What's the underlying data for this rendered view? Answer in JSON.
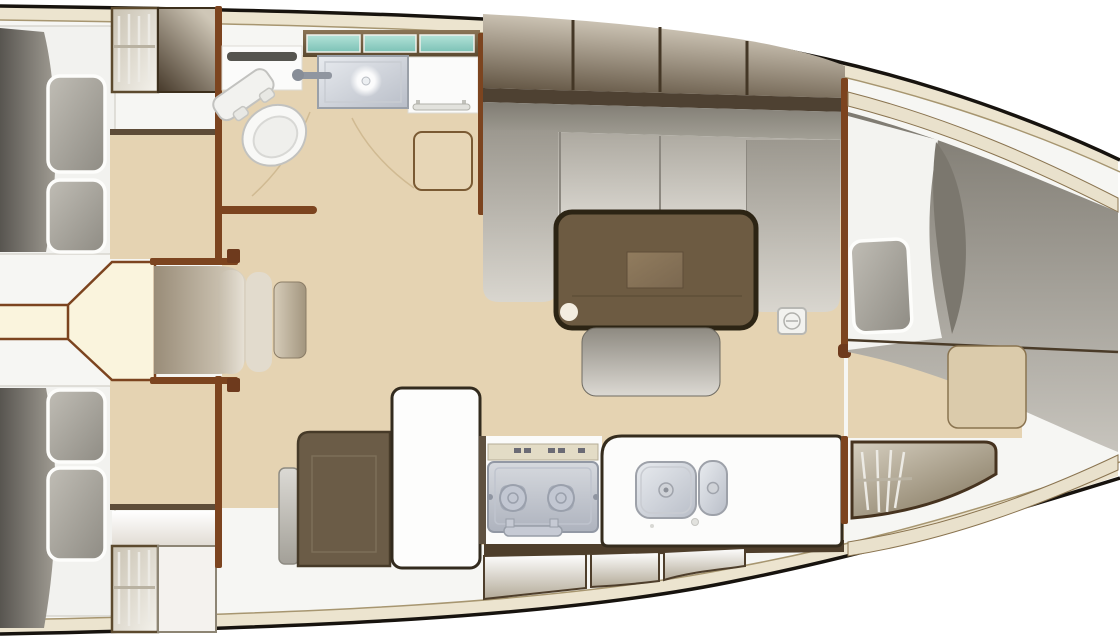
{
  "diagram": {
    "kind": "yacht-interior-floor-plan",
    "view": "top-down",
    "orientation": "bow-right-stern-left",
    "visible_text": []
  },
  "palette": {
    "background": "#ffffff",
    "hull_outline": "#17130e",
    "deck_band": "#ece4cf",
    "inner_white": "#f6f6f3",
    "floor_tan": "#e5d3b2",
    "companionway_ivory": "#faf4dd",
    "wall_wood": "#7c441f",
    "dark_trim": "#3a3020",
    "table_wood": "#6d5b42",
    "cabinet_dark": "#6b5c47",
    "cabinet_gradient_light": "#d7cfc0",
    "upholstery_gray": "#a7a39a",
    "mattress_gray": "#8f8b82",
    "metal_gray": "#c6cad3",
    "teal_glass": "#8fd0c4",
    "fixture_white": "#fbfbfa",
    "band_brown": "#5e4c38"
  },
  "rooms": {
    "aft_cabin_starboard": {
      "label": "Aft cabin (starboard)",
      "furniture": [
        "double-berth",
        "duvet",
        "pillows",
        "hanging-locker",
        "cabinet"
      ]
    },
    "aft_cabin_port": {
      "label": "Aft cabin (port)",
      "furniture": [
        "double-berth",
        "duvet",
        "pillows",
        "hanging-locker",
        "cabinet"
      ]
    },
    "companionway": {
      "label": "Companionway",
      "furniture": [
        "cockpit-passage",
        "entry-steps",
        "handrails"
      ]
    },
    "head": {
      "label": "Head / bathroom",
      "furniture": [
        "toilet",
        "washbasin",
        "faucet",
        "window-strip",
        "towel-rails",
        "door",
        "counter"
      ]
    },
    "saloon": {
      "label": "Saloon",
      "furniture": [
        "overhead-lockers",
        "u-shaped-sofa",
        "chaise-end",
        "dining-table",
        "bench-seat",
        "deck-fitting"
      ]
    },
    "galley": {
      "label": "Galley",
      "furniture": [
        "refrigerator-cabinet",
        "worktop",
        "two-burner-stove",
        "oven-handle",
        "double-sink",
        "hull-lockers"
      ]
    },
    "forward_cabin": {
      "label": "Forward cabin",
      "furniture": [
        "v-berth-mattress",
        "bedding",
        "pillow",
        "seat",
        "hanging-locker",
        "hull-shelf"
      ]
    }
  }
}
